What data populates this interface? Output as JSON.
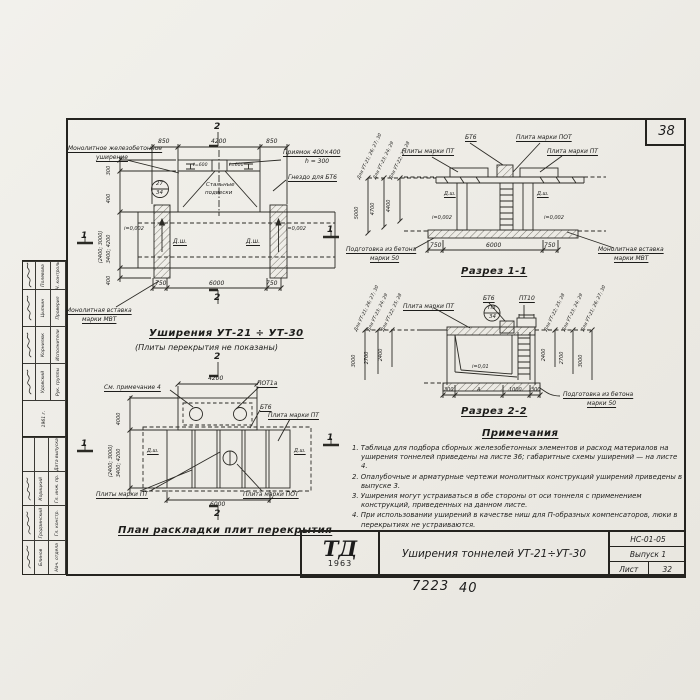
{
  "page": {
    "sheet_corner": "38",
    "handwritten_left": "7223",
    "handwritten_right": "40"
  },
  "title_block": {
    "logo_top": "ТД",
    "logo_year": "1963",
    "title": "Уширения тоннелей УТ-21÷УТ-30",
    "doc_code": "НС-01-05",
    "issue": "Выпуск 1",
    "sheet_label": "Лист",
    "sheet_number": "32"
  },
  "stamp": {
    "group1": {
      "rows": [
        {
          "role": "Рук. группы",
          "name": "Удовский"
        },
        {
          "role": "Исполнители",
          "name": "Корнилюк"
        },
        {
          "role": "Проверил",
          "name": "Цыпкин"
        },
        {
          "role": "Н. контроль",
          "name": "Полевова"
        }
      ],
      "year": "1961 г."
    },
    "group2": {
      "rows": [
        {
          "role": "Нач. отдела",
          "name": "Блинов"
        },
        {
          "role": "Гл. констр.",
          "name": "Гродзинский"
        },
        {
          "role": "Гл. инж. пр.",
          "name": "Корицкий"
        },
        {
          "role": "Дата выпуска",
          "name": ""
        }
      ]
    }
  },
  "plan_top": {
    "caption": "Уширения УТ-21 ÷ УТ-30",
    "subcaption": "(Плиты перекрытия не показаны)",
    "label_widening_1": "Монолитное железобетонное",
    "label_widening_2": "уширение",
    "label_pit_1": "Приямок 400×400",
    "label_pit_2": "h = 300",
    "label_socket": "Гнездо для БТ6",
    "label_ties_1": "Стальные",
    "label_ties_2": "подвески",
    "label_insert_1": "Монолитная вставка",
    "label_insert_2": "марки МВТ",
    "detail_ref_top": "27",
    "detail_ref_bottom": "34",
    "joint_label": "Д.ш.",
    "slope_label": "i=0,002",
    "pit_dim_left": "ℓ=600",
    "pit_dim_right": "ℓ=600",
    "dim_top_left": "850",
    "dim_top_mid": "4200",
    "dim_top_right": "850",
    "dim_bottom_left": "750",
    "dim_bottom_mid": "6000",
    "dim_bottom_right": "750",
    "dim_left_1": "300",
    "dim_left_2": "400",
    "dim_left_3": "(2400; 3000)",
    "dim_left_4": "3400; 4200",
    "dim_left_5": "400",
    "section_mark_2": "2",
    "section_mark_1": "1"
  },
  "section_1": {
    "caption": "Разрез 1-1",
    "label_pt_left": "Плиты марки ПТ",
    "label_bt6": "БТ6",
    "label_pot": "Плита марки ПОТ",
    "label_pt_right": "Плита марки ПТ",
    "joint_label": "Д.ш.",
    "slope_label": "i=0,002",
    "label_base_1": "Подготовка из бетона",
    "label_base_2": "марки 50",
    "label_insert_1": "Монолитная вставка",
    "label_insert_2": "марки МВТ",
    "dim_bottom_left": "750",
    "dim_bottom_mid": "6000",
    "dim_bottom_right": "750",
    "rot_dims": [
      {
        "label": "Для УТ-21; 26; 27; 30",
        "value": "5000"
      },
      {
        "label": "Для УТ-23; 24; 29",
        "value": "4700"
      },
      {
        "label": "Для УТ-22; 25; 28",
        "value": "4400"
      }
    ]
  },
  "plan_bottom": {
    "caption": "План раскладки плит перекрытия",
    "label_note": "См. примечание 4",
    "label_pot1a": "ПОТ1а",
    "label_bt6": "БТ6",
    "label_pt_right": "Плита марки ПТ",
    "label_pt_bottom": "Плиты марки ПТ",
    "label_pot_bottom": "Плита марки ПОТ",
    "joint_label": "Д.ш.",
    "dim_top": "4200",
    "dim_bottom": "6000",
    "dim_left_1": "4000",
    "dim_left_2": "(2400; 3000)",
    "dim_left_3": "3400; 4200",
    "section_mark_2": "2",
    "section_mark_1": "1"
  },
  "section_2": {
    "caption": "Разрез 2-2",
    "label_pt": "Плита марки ПТ",
    "label_bt6": "БТ6",
    "label_pt10": "ПТ10",
    "detail_ref_top": "ПЗ",
    "detail_ref_bottom": "34",
    "slope_label": "i=0,01",
    "label_base_1": "Подготовка из бетона",
    "label_base_2": "марки 50",
    "dims_bottom": [
      "300",
      "А",
      "1000",
      "300"
    ],
    "rot_dims_left": [
      {
        "label": "Для УТ-21; 26; 27; 30",
        "value": "3000"
      },
      {
        "label": "Для УТ-23; 24; 29",
        "value": "2700"
      },
      {
        "label": "Для УТ-22; 25; 28",
        "value": "2400"
      }
    ],
    "rot_dims_right": [
      {
        "label": "Для УТ-22; 25; 28",
        "value": "2400"
      },
      {
        "label": "Для УТ-23; 24; 29",
        "value": "2700"
      },
      {
        "label": "Для УТ-21; 26; 27; 30",
        "value": "3000"
      }
    ]
  },
  "notes": {
    "heading": "Примечания",
    "items": [
      "1. Таблица для подбора сборных железобетонных элементов и расход материалов на уширения тоннелей приведены на листе 36; габаритные схемы уширений — на листе 4.",
      "2. Опалубочные и арматурные чертежи монолитных конструкций уширений приведены в выпуске 3.",
      "3. Уширения могут устраиваться в обе стороны от оси тоннеля с применением конструкций, приведенных на данном листе.",
      "4. При использовании уширений в качестве ниш для П-образных компенсаторов, люки в перекрытиях не устраиваются."
    ]
  },
  "colors": {
    "ink": "#1d1d1b",
    "paper": "#efeee8"
  }
}
